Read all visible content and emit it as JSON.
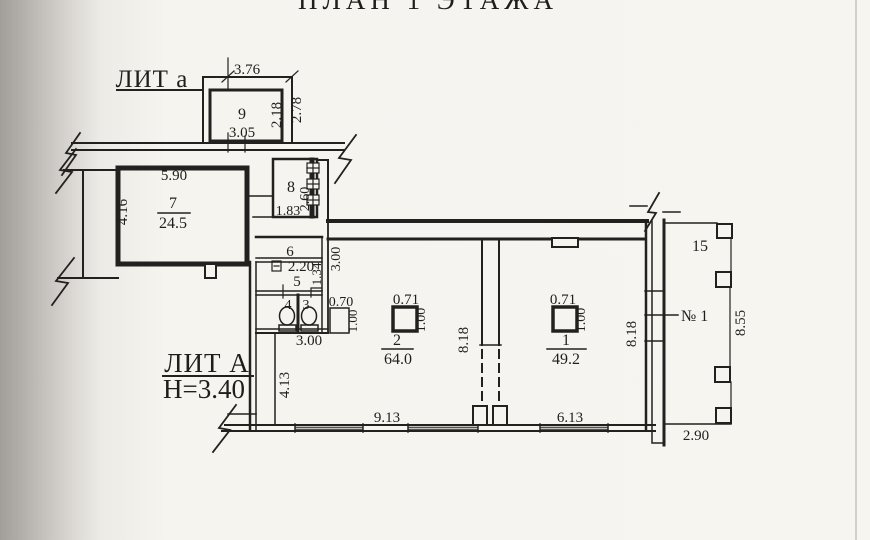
{
  "title": "ПЛАН 1 ЭТАЖА",
  "labels": {
    "lit_annex": "ЛИТ а",
    "lit_main": "ЛИТ А",
    "floor_height": "Н=3.40",
    "unit_number": "№ 1",
    "porch_number": "15"
  },
  "rooms": {
    "r1": {
      "num": "1",
      "area": "49.2"
    },
    "r2": {
      "num": "2",
      "area": "64.0"
    },
    "r3": {
      "num": "3"
    },
    "r4": {
      "num": "4"
    },
    "r5": {
      "num": "5"
    },
    "r6": {
      "num": "6"
    },
    "r7": {
      "num": "7",
      "area": "24.5"
    },
    "r8": {
      "num": "8"
    },
    "r9": {
      "num": "9"
    }
  },
  "dims": {
    "room9_top": "3.76",
    "room9_outer_right": "2.78",
    "room9_inner_right": "2.18",
    "room9_bottom": "3.05",
    "room7_top": "5.90",
    "room7_left": "4.16",
    "room8_bottom": "1.83",
    "room8_right": "2.60",
    "room5_width": "2.20",
    "room5_right": "1.34",
    "san_block_right": "3.00",
    "san_block_bottom": "3.00",
    "shaft_width": "0.70",
    "shaft_height": "1.00",
    "col2_width": "0.71",
    "col2_height": "1.00",
    "col1_width": "0.71",
    "col1_height": "1.00",
    "room2_side": "8.18",
    "room1_side": "8.18",
    "left_inner": "4.13",
    "room2_bottom": "9.13",
    "room1_bottom": "6.13",
    "porch_right": "8.55",
    "porch_bottom": "2.90"
  }
}
